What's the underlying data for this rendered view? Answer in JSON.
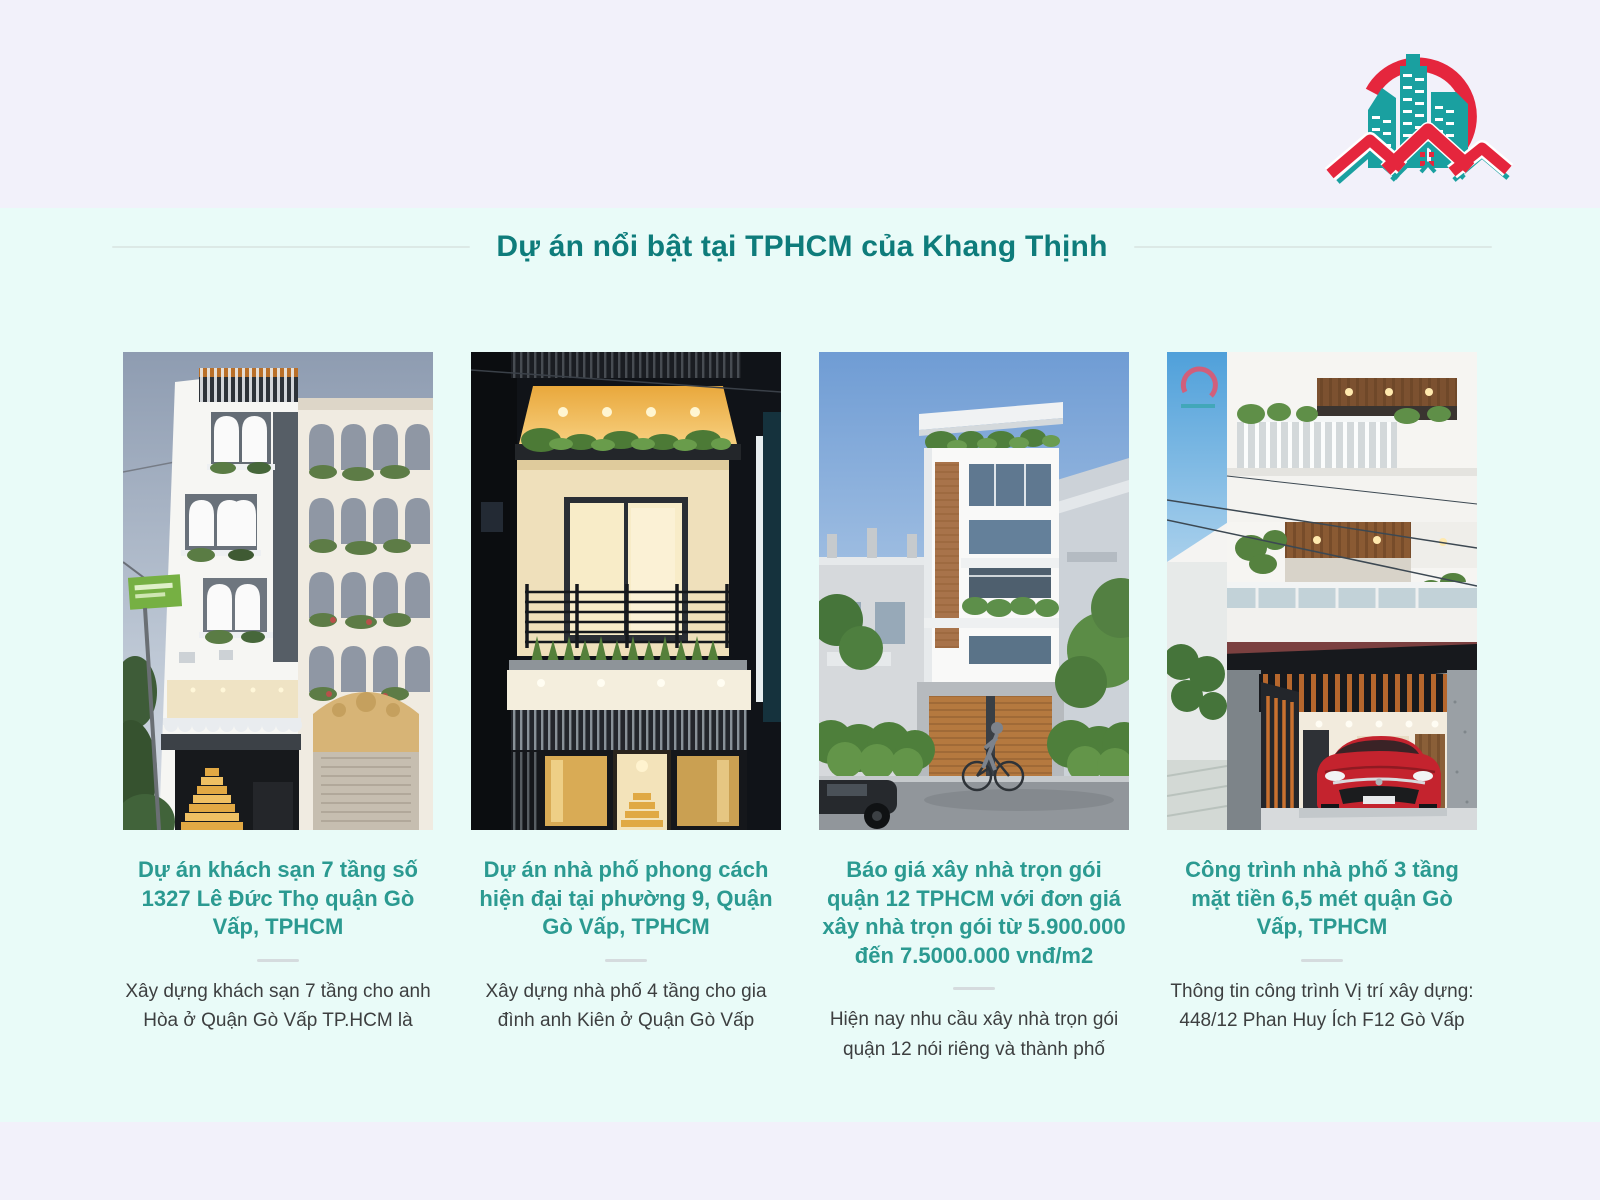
{
  "colors": {
    "page_bg": "#f2f1fa",
    "band_bg": "#e9fbf8",
    "brand_red": "#e5263d",
    "brand_teal": "#1aa0a0",
    "heading_teal": "#0e7c7b",
    "title_teal": "#2b9a91",
    "body_text": "#3d3f40",
    "rule_gray": "#dce9e6",
    "divider_gray": "#d5dbde"
  },
  "logo": {
    "icon": "teal-buildings-red-roofs-swoosh-logo"
  },
  "section": {
    "heading": "Dự án nổi bật tại TPHCM của Khang Thịnh"
  },
  "cards": [
    {
      "title": "Dự án khách sạn 7 tầng số 1327 Lê Đức Thọ quận Gò Vấp, TPHCM",
      "description": "Xây dựng khách sạn 7 tầng cho anh Hòa ở Quận Gò Vấp TP.HCM là"
    },
    {
      "title": "Dự án nhà phố phong cách hiện đại tại phường 9, Quận Gò Vấp, TPHCM",
      "description": "Xây dựng nhà phố 4 tầng cho gia đình anh Kiên ở Quận Gò Vấp"
    },
    {
      "title": "Báo giá xây nhà trọn gói quận 12 TPHCM với đơn giá xây nhà trọn gói từ 5.900.000 đến 7.5000.000 vnđ/m2",
      "description": "Hiện nay nhu cầu xây nhà trọn gói quận 12 nói riêng và thành phố"
    },
    {
      "title": "Công trình nhà phố 3 tầng mặt tiền 6,5 mét quận Gò Vấp, TPHCM",
      "description": "Thông tin công trình Vị trí xây dựng: 448/12 Phan Huy Ích F12 Gò Vấp"
    }
  ]
}
